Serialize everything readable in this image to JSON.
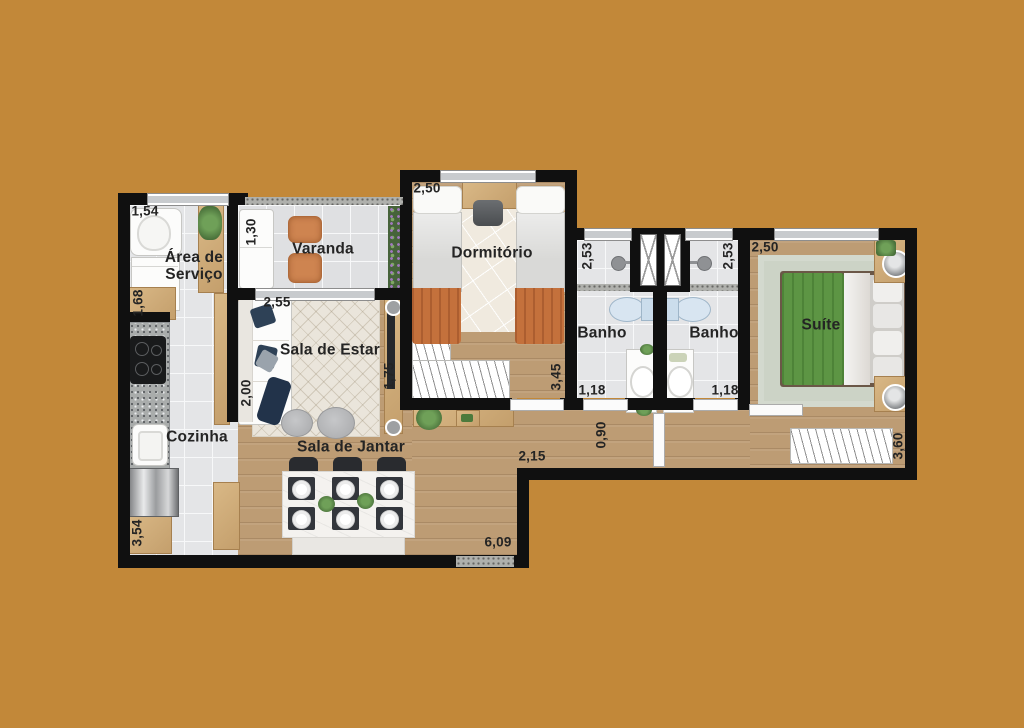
{
  "plan_title": "Apartment floor plan",
  "colors": {
    "background": "#C28839",
    "wall": "#101010",
    "wood": "#BD9C74",
    "tile": "#E4E5E7",
    "accent_orange": "#C97842",
    "accent_green": "#5D9544",
    "accent_navy": "#2E4156"
  },
  "rooms": {
    "area_servico": "Área de\nServiço",
    "varanda": "Varanda",
    "dormitorio": "Dormitório",
    "banho_left": "Banho",
    "banho_right": "Banho",
    "suite": "Suíte",
    "sala_estar": "Sala de Estar",
    "cozinha": "Cozinha",
    "sala_jantar": "Sala de Jantar"
  },
  "dimensions": {
    "servico_width": "1,54",
    "varanda_width": "1,30",
    "servico_height": "1,68",
    "estar_width": "2,55",
    "estar_height": "2,00",
    "estar_depth": "1,75",
    "dormitorio_width": "2,50",
    "dormitorio_height": "3,45",
    "banho_left_height": "2,53",
    "banho_right_height": "2,53",
    "banho_left_width": "1,18",
    "banho_right_width": "1,18",
    "suite_width": "2,50",
    "suite_height": "3,60",
    "hall_height": "0,90",
    "hall_width": "2,15",
    "cozinha_height": "3,54",
    "total_width": "6,09"
  }
}
